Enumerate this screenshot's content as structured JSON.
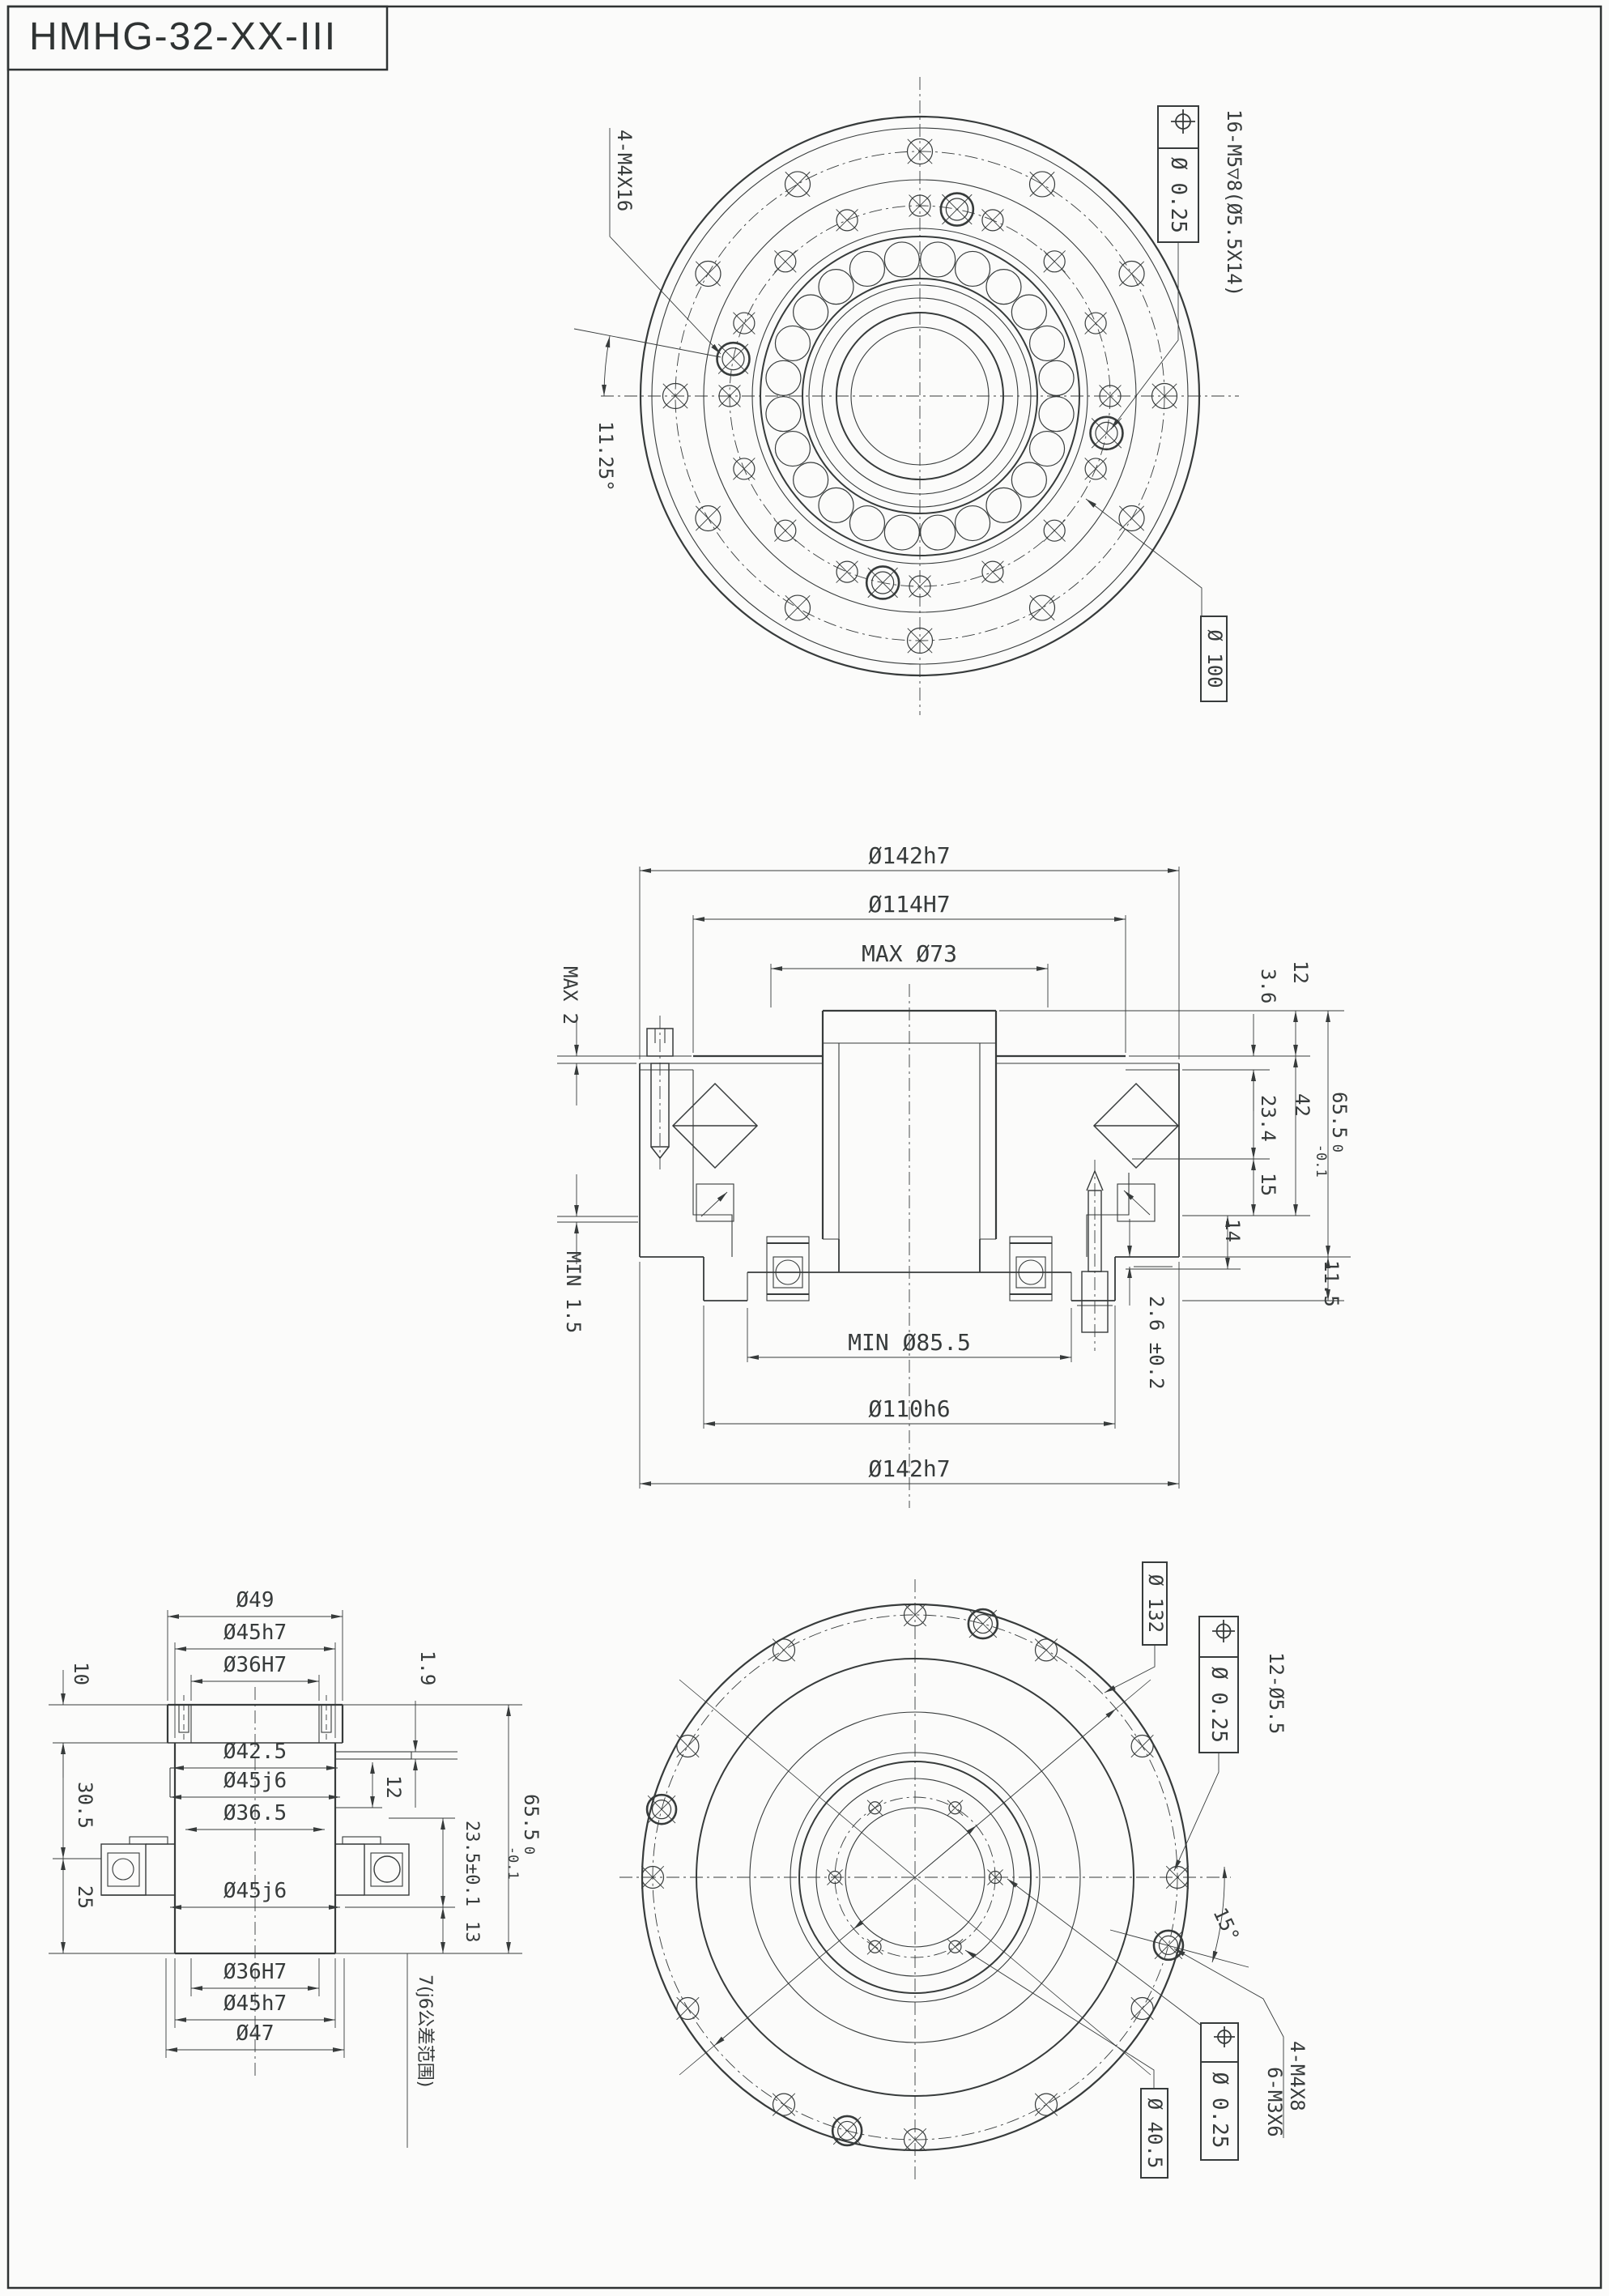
{
  "title_block": {
    "model": "HMHG-32-XX-III"
  },
  "front_view": {
    "screw_note": "4-M4X16",
    "angle_dim": "11.25°",
    "position_frame": {
      "tolerance": "Ø 0.25"
    },
    "tap_note": "16-M5▽8(Ø5.5X14)",
    "bolt_circle_dia": "Ø 100"
  },
  "section_view": {
    "dia_142_top": "Ø142h7",
    "dia_114": "Ø114H7",
    "dia_73_max": "MAX Ø73",
    "gap_max": "MAX 2",
    "gap_min": "MIN 1.5",
    "len_12": "12",
    "len_3_6": "3.6",
    "len_23_4": "23.4",
    "len_42": "42",
    "len_15": "15",
    "len_14": "14",
    "height_65_5": {
      "value": "65.5",
      "tol_upper": "0",
      "tol_lower": "-0.1"
    },
    "len_11_5": "11.5",
    "len_2_6": "2.6 ±0.2",
    "dia_85_5_min": "MIN Ø85.5",
    "dia_110": "Ø110h6",
    "dia_142_bottom": "Ø142h7"
  },
  "shaft_view": {
    "dia_49": "Ø49",
    "dia_45h7_top": "Ø45h7",
    "dia_36H7_top": "Ø36H7",
    "len_1_9": "1.9",
    "len_10": "10",
    "len_30_5": "30.5",
    "len_25": "25",
    "dia_42_5": "Ø42.5",
    "dia_45j6_mid": "Ø45j6",
    "dia_36_5": "Ø36.5",
    "len_12": "12",
    "len_23_5": "23.5±0.1",
    "len_13": "13",
    "height_65_5": {
      "value": "65.5",
      "tol_upper": "0",
      "tol_lower": "-0.1"
    },
    "dia_45j6_low": "Ø45j6",
    "dia_36H7_bottom": "Ø36H7",
    "dia_45h7_bottom": "Ø45h7",
    "dia_47": "Ø47",
    "tolerance_note": "7(j6公差范围)"
  },
  "rear_view": {
    "dia_132": "Ø 132",
    "hole_note": "12-Ø5.5",
    "position_frame_outer": {
      "tolerance": "Ø 0.25"
    },
    "angle_dim": "15°",
    "screw_note": "4-M4X8",
    "tap_note": "6-M3X6",
    "position_frame_inner": {
      "tolerance": "Ø 0.25"
    },
    "bolt_circle_dia": "Ø 40.5"
  }
}
